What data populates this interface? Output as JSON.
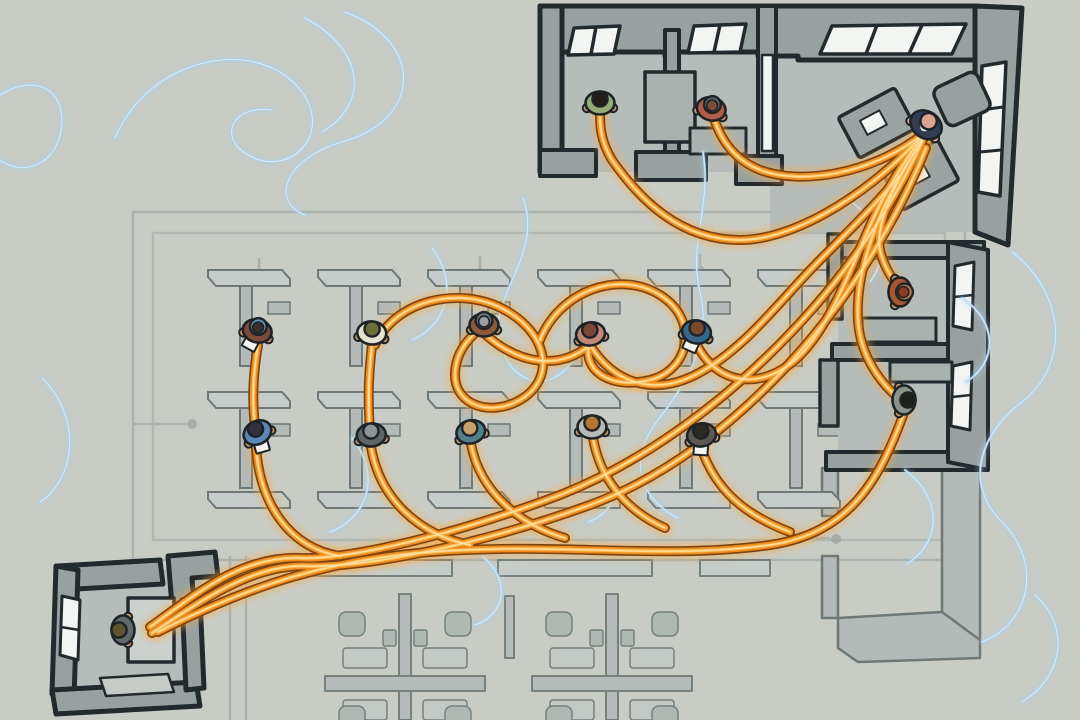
{
  "scene": {
    "width": 1080,
    "height": 720,
    "alt": "Top-down illustrated office floor plan: workers in cubicles and offices linked by glowing orange cables that converge on a manager's desk in the top-right corner office; faint blue wisps drift across a gray-green plan"
  },
  "palette": {
    "bg": "#c8ccc5",
    "plan": "#939d9a",
    "part_fill": "#b4bab7",
    "part_top": "#c6ccc9",
    "part_stroke": "#6e7876",
    "desk": "#c3c9c6",
    "chair": "#aeb6b3",
    "wall": "#98a1a0",
    "wall_light": "#aab2b0",
    "floor": "#b6bcba",
    "floor_shade": "#a9b0ae",
    "outline": "#232a2e",
    "window": "#f3f5f3",
    "cable_outline": "#7e4410",
    "cable_body": "#ec8c1f",
    "cable_core": "#ffba55",
    "cable_highlight": "#ffe3a6",
    "cable_glow": "#ffa93c",
    "swirl": "#a9d2ec",
    "swirl_core": "#ddeffb",
    "ink": "#1d2326",
    "skin": "#c9996e",
    "paper": "#f4f5f0"
  },
  "partition_grid": {
    "cols": [
      196,
      306,
      416,
      526,
      636,
      746
    ],
    "rows": [
      270,
      392
    ],
    "feet_row": 492,
    "wall_h": 80,
    "cap_w": 74
  },
  "swirls": [
    {
      "d": "M115,138 C150,55 260,35 302,92 C332,133 292,176 252,157 C216,140 231,104 272,110"
    },
    {
      "d": "M305,18 C362,48 372,102 322,132"
    },
    {
      "d": "M345,12 C425,42 422,120 342,142 C288,157 268,200 305,215"
    },
    {
      "d": "M703,152 C712,205 688,245 700,292 C712,340 688,382 658,420 C628,458 638,498 678,518"
    },
    {
      "d": "M523,198 C545,258 482,300 502,350 C516,386 550,392 572,362"
    },
    {
      "d": "M432,248 C462,288 442,328 412,340"
    },
    {
      "d": "M1012,252 C1064,292 1072,362 1022,402 C982,432 962,482 1002,522 C1042,562 1032,622 982,642"
    },
    {
      "d": "M845,198 C882,220 892,252 870,282"
    },
    {
      "d": "M352,438 C384,478 364,520 330,532"
    },
    {
      "d": "M42,378 C84,420 74,480 40,502"
    },
    {
      "d": "M0,95 C40,70 70,95 60,135 C52,168 20,175 0,160"
    },
    {
      "d": "M1035,595 C1072,628 1062,678 1022,702"
    },
    {
      "d": "M595,452 C625,478 618,512 588,522"
    },
    {
      "d": "M962,298 C998,322 998,362 966,382"
    },
    {
      "d": "M482,556 C512,580 505,615 475,625"
    },
    {
      "d": "M905,470 C945,500 940,545 905,565"
    }
  ],
  "cables": [
    {
      "d": "M925,132 C880,185 800,240 740,240 C680,240 640,200 612,160 C600,140 600,125 600,112"
    },
    {
      "d": "M922,135 C870,175 800,185 760,170 C735,160 720,140 713,115"
    },
    {
      "d": "M925,136 C895,180 875,225 880,250 C884,268 893,280 903,293"
    },
    {
      "d": "M923,140 C880,200 855,270 858,320 C860,355 880,385 905,403"
    },
    {
      "d": "M922,142 C850,300 700,440 560,495 C440,540 340,560 300,558 C240,556 195,595 150,627"
    },
    {
      "d": "M926,148 C870,290 740,450 590,505 C470,548 360,568 305,566 C250,565 200,602 152,633"
    },
    {
      "d": "M158,632 C250,585 330,560 430,552 C560,542 660,560 770,545 C850,533 880,480 905,410"
    },
    {
      "d": "M697,345 C720,390 770,390 805,350 C840,310 860,240 885,195 C900,168 912,150 922,138"
    },
    {
      "d": "M590,345 C615,385 655,395 695,375 C745,350 780,300 820,260 C850,230 880,200 900,175"
    },
    {
      "d": "M375,345 C395,300 460,285 505,310 C550,335 555,380 520,400 C490,417 455,405 455,375 C455,345 480,330 483,325"
    },
    {
      "d": "M372,345 C368,380 368,400 370,433"
    },
    {
      "d": "M258,345 C252,380 252,408 256,432"
    },
    {
      "d": "M256,447 C260,505 290,548 340,556"
    },
    {
      "d": "M371,447 C380,500 420,535 470,545"
    },
    {
      "d": "M471,444 C480,492 520,525 565,538"
    },
    {
      "d": "M593,438 C600,478 625,510 665,528"
    },
    {
      "d": "M701,447 C715,490 745,515 790,532"
    },
    {
      "d": "M486,335 C520,365 560,370 590,345"
    },
    {
      "d": "M540,340 C560,290 620,270 660,295 C700,320 690,370 650,380 C610,390 580,370 590,340"
    }
  ],
  "people": [
    {
      "name": "worker-brown-bluecap",
      "x": 258,
      "y": 328,
      "rot": 15,
      "shirt": "#7d4a3c",
      "head": "#39302a",
      "cap": "#6f93b5",
      "paper": true
    },
    {
      "name": "worker-cream",
      "x": 372,
      "y": 330,
      "rot": 5,
      "shirt": "#e6e2d2",
      "head": "#6e6d3c"
    },
    {
      "name": "worker-graycap",
      "x": 484,
      "y": 322,
      "rot": 0,
      "shirt": "#8a5a3a",
      "head": "#9aa0a2",
      "cap": "#6a747a"
    },
    {
      "name": "worker-pink",
      "x": 590,
      "y": 331,
      "rot": -10,
      "shirt": "#c08878",
      "head": "#7c4638"
    },
    {
      "name": "worker-blue-paper",
      "x": 697,
      "y": 329,
      "rot": 10,
      "shirt": "#38678c",
      "head": "#7a4a28",
      "paper": true
    },
    {
      "name": "worker-blue",
      "x": 256,
      "y": 430,
      "rot": -30,
      "shirt": "#5c86b8",
      "head": "#32323c",
      "paper": true
    },
    {
      "name": "worker-darkgray",
      "x": 371,
      "y": 432,
      "rot": -5,
      "shirt": "#606568",
      "head": "#8f9496"
    },
    {
      "name": "worker-teal",
      "x": 470,
      "y": 429,
      "rot": -15,
      "shirt": "#517f8a",
      "head": "#c9a06b"
    },
    {
      "name": "worker-lightgray",
      "x": 592,
      "y": 424,
      "rot": 0,
      "shirt": "#b7bab6",
      "head": "#b5762f"
    },
    {
      "name": "worker-dark-paper",
      "x": 701,
      "y": 432,
      "rot": -10,
      "shirt": "#5e5852",
      "head": "#2c2824",
      "paper": true
    },
    {
      "name": "worker-green-office",
      "x": 600,
      "y": 100,
      "rot": 0,
      "shirt": "#93ad74",
      "head": "#241d18"
    },
    {
      "name": "worker-red-headset",
      "x": 712,
      "y": 106,
      "rot": 15,
      "shirt": "#b05c46",
      "head": "#7c4c3c",
      "cap": "#5d646a"
    },
    {
      "name": "manager",
      "x": 928,
      "y": 122,
      "rot": 35,
      "shirt": "#333d54",
      "head": "#d9a392",
      "suit": true,
      "big": true
    },
    {
      "name": "worker-orange-office",
      "x": 903,
      "y": 292,
      "rot": 90,
      "shirt": "#a85530",
      "head": "#8a3b26",
      "cap": "#c77f4f"
    },
    {
      "name": "worker-sage-office",
      "x": 907,
      "y": 400,
      "rot": 90,
      "shirt": "#8b948a",
      "head": "#1f211d"
    },
    {
      "name": "worker-corner-office",
      "x": 120,
      "y": 630,
      "rot": -90,
      "shirt": "#626a6e",
      "head": "#5c5732"
    }
  ]
}
